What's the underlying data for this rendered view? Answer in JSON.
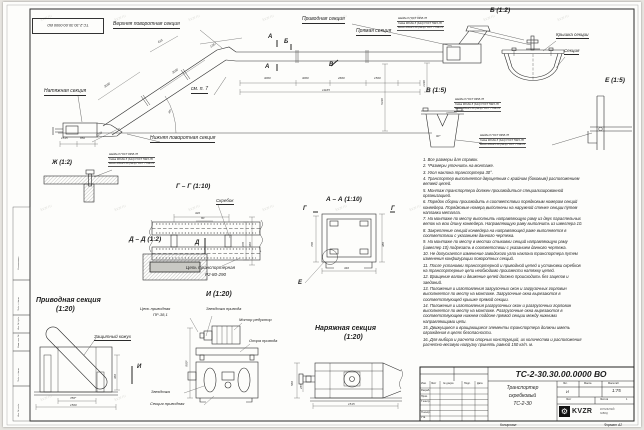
{
  "sheet": {
    "watermark": "kvzr.ru",
    "footer_copied": "Копировал",
    "footer_format": "Формат А2",
    "margin_labels": [
      "Согласовано",
      "Подп. и дата",
      "Инв. № дубл.",
      "Взам. инв. №",
      "Подп. и дата",
      "Инв. № подл."
    ]
  },
  "main": {
    "upper_turn": "Верхняя поворотная секция",
    "straight": "Прямая секция",
    "drive": "Приводная секция",
    "tension": "Натяжная секция",
    "lower_turn": "Нижняя поворотная секция",
    "see_note": "см. п. 7",
    "marker_a": "А",
    "marker_b": "Б",
    "marker_v": "В",
    "dims": {
      "d3000": "3000",
      "d2660": "2660",
      "d1500": "1500",
      "total": "11165",
      "h1": "5430",
      "h2": "1430",
      "d615": "615",
      "d1367": "1367",
      "d1249": "1249",
      "d1515": "1515",
      "d850": "850",
      "angle": "30°"
    }
  },
  "callout": {
    "l1": "Шайба 8 ГОСТ 6958-78",
    "l2": "Гайка М8-6Н.5 (S13) ГОСТ 5915-70",
    "l3": "Болт М8х25.58 (S13) ГОСТ 7796-70"
  },
  "views": {
    "b": {
      "title": "Б (1:2)",
      "cover": "Крышка секции",
      "section": "Секция"
    },
    "v": {
      "title": "В (1:5)",
      "angle": "90°"
    },
    "e": {
      "title": "Е (1:5)"
    },
    "zh": {
      "title": "Ж (1:2)"
    },
    "gg": {
      "title": "Г – Г (1:10)",
      "scraper": "Скребок",
      "chain1": "Цепь транспортерная",
      "chain2": "Р2-80-290",
      "marker": "Д",
      "d320": "320",
      "d80": "80",
      "d370": "370",
      "d460": "460"
    },
    "aa": {
      "title": "А – А (1:10)",
      "marker_g": "Г",
      "marker_e": "Е",
      "d700": "700",
      "d380": "380",
      "d340": "340"
    },
    "dd": {
      "title": "Д – Д (1:2)"
    },
    "drive": {
      "title": "Приводная секция",
      "scale": "(1:20)",
      "cover": "Защитный кожух",
      "marker": "И",
      "d780": "780*",
      "d1500": "1500",
      "d360": "360"
    },
    "i": {
      "title": "И (1:20)",
      "chain1": "Цепь приводная",
      "chain2": "ПР-38,1",
      "sprocket_drive": "Звездочка привода",
      "motor": "Мотор редуктор",
      "support": "Опора привода",
      "sprocket": "Звездочка",
      "section": "Секция приводная",
      "d800": "800*"
    },
    "t": {
      "title": "Наряжная секция",
      "scale": "(1:20)",
      "d1515": "1515",
      "d560": "560",
      "d255": "255"
    }
  },
  "notes": [
    "1. Все размеры для справок.",
    "2. *Размеры уточнить на монтаже.",
    "3. Угол наклона транспортера 30°.",
    "4. Транспортер выполняется двухцепным с крайним (боковым) расположением ветвей цепей.",
    "5. Монтаж транспортера должен производиться специализированной организацией.",
    "6. Порядок сборки производить в соответствии порядковым номерам секций конвейера. Порядковые номера выполнены на наружной стенке секции путем наплавки металла.",
    "7. На монтаже по месту выполнить направляющую раму из двух параллельных веток на всю длину конвейера. Направляющую раму выполнить из швеллера 10.",
    "8. Закрепление секций конвейера на направляющей раме выполняется в соответствии с указанием данного чертежа.",
    "9. На монтаже по месту в местах стыковки секций направляющую раму (швеллер 10) подрезать в соответствии с указанием данного чертежа.",
    "10. Не допускается изменение заводского угла наклона транспортера путем изменения конфигурации поворотных секций.",
    "11. После установки транспортерной и приводной цепей и установки скребков на транспортерные цепи необходимо произвести натяжку цепей.",
    "12. Вращение валов и движение цепей должно происходить без зацепов и заеданий.",
    "13. Положения и изготовления загрузочных окон и загрузочных горловин выполняется по месту на монтаже. Загрузочные окна вырезаются в соответствующей крышке прямой секции.",
    "14. Положения и изготовления разгрузочных окон и разгрузочных горловин выполняется по месту на монтаже. Разгрузочные окна вырезаются в соответствующем нижнем поддоне прямой секции между нижними направляющими цепи.",
    "15. Движущиеся и вращающиеся элементы транспортера должны иметь ограждения в целях безопасности.",
    "16. Для выбора и расчета опорных конструкций, их количества и расположения расчетно-весовую нагрузку принять равной 150 кг/п. м."
  ],
  "title_block": {
    "doc_number": "ТС-2-30.30.00.0000  ВО",
    "name1": "Транспортер",
    "name2": "скребковый",
    "name3": "ТС-2-30",
    "lit_label": "Лит.",
    "mass_label": "Масса",
    "scale_label": "Масштаб",
    "lit": "И",
    "scale": "1:75",
    "sheet_label": "Лист",
    "sheets_label": "Листов",
    "sheets": "1",
    "cols": {
      "izm": "Изм.",
      "list": "Лист",
      "doc": "№ докум.",
      "podp": "Подп.",
      "data": "Дата"
    },
    "rows": [
      "Разраб.",
      "Пров.",
      "Т.контр.",
      "Н.контр.",
      "Утв."
    ],
    "logo": "KVZR",
    "logo_sub1": "КОТЕЛЬНЫЙ",
    "logo_sub2": "ЗАВОД"
  }
}
